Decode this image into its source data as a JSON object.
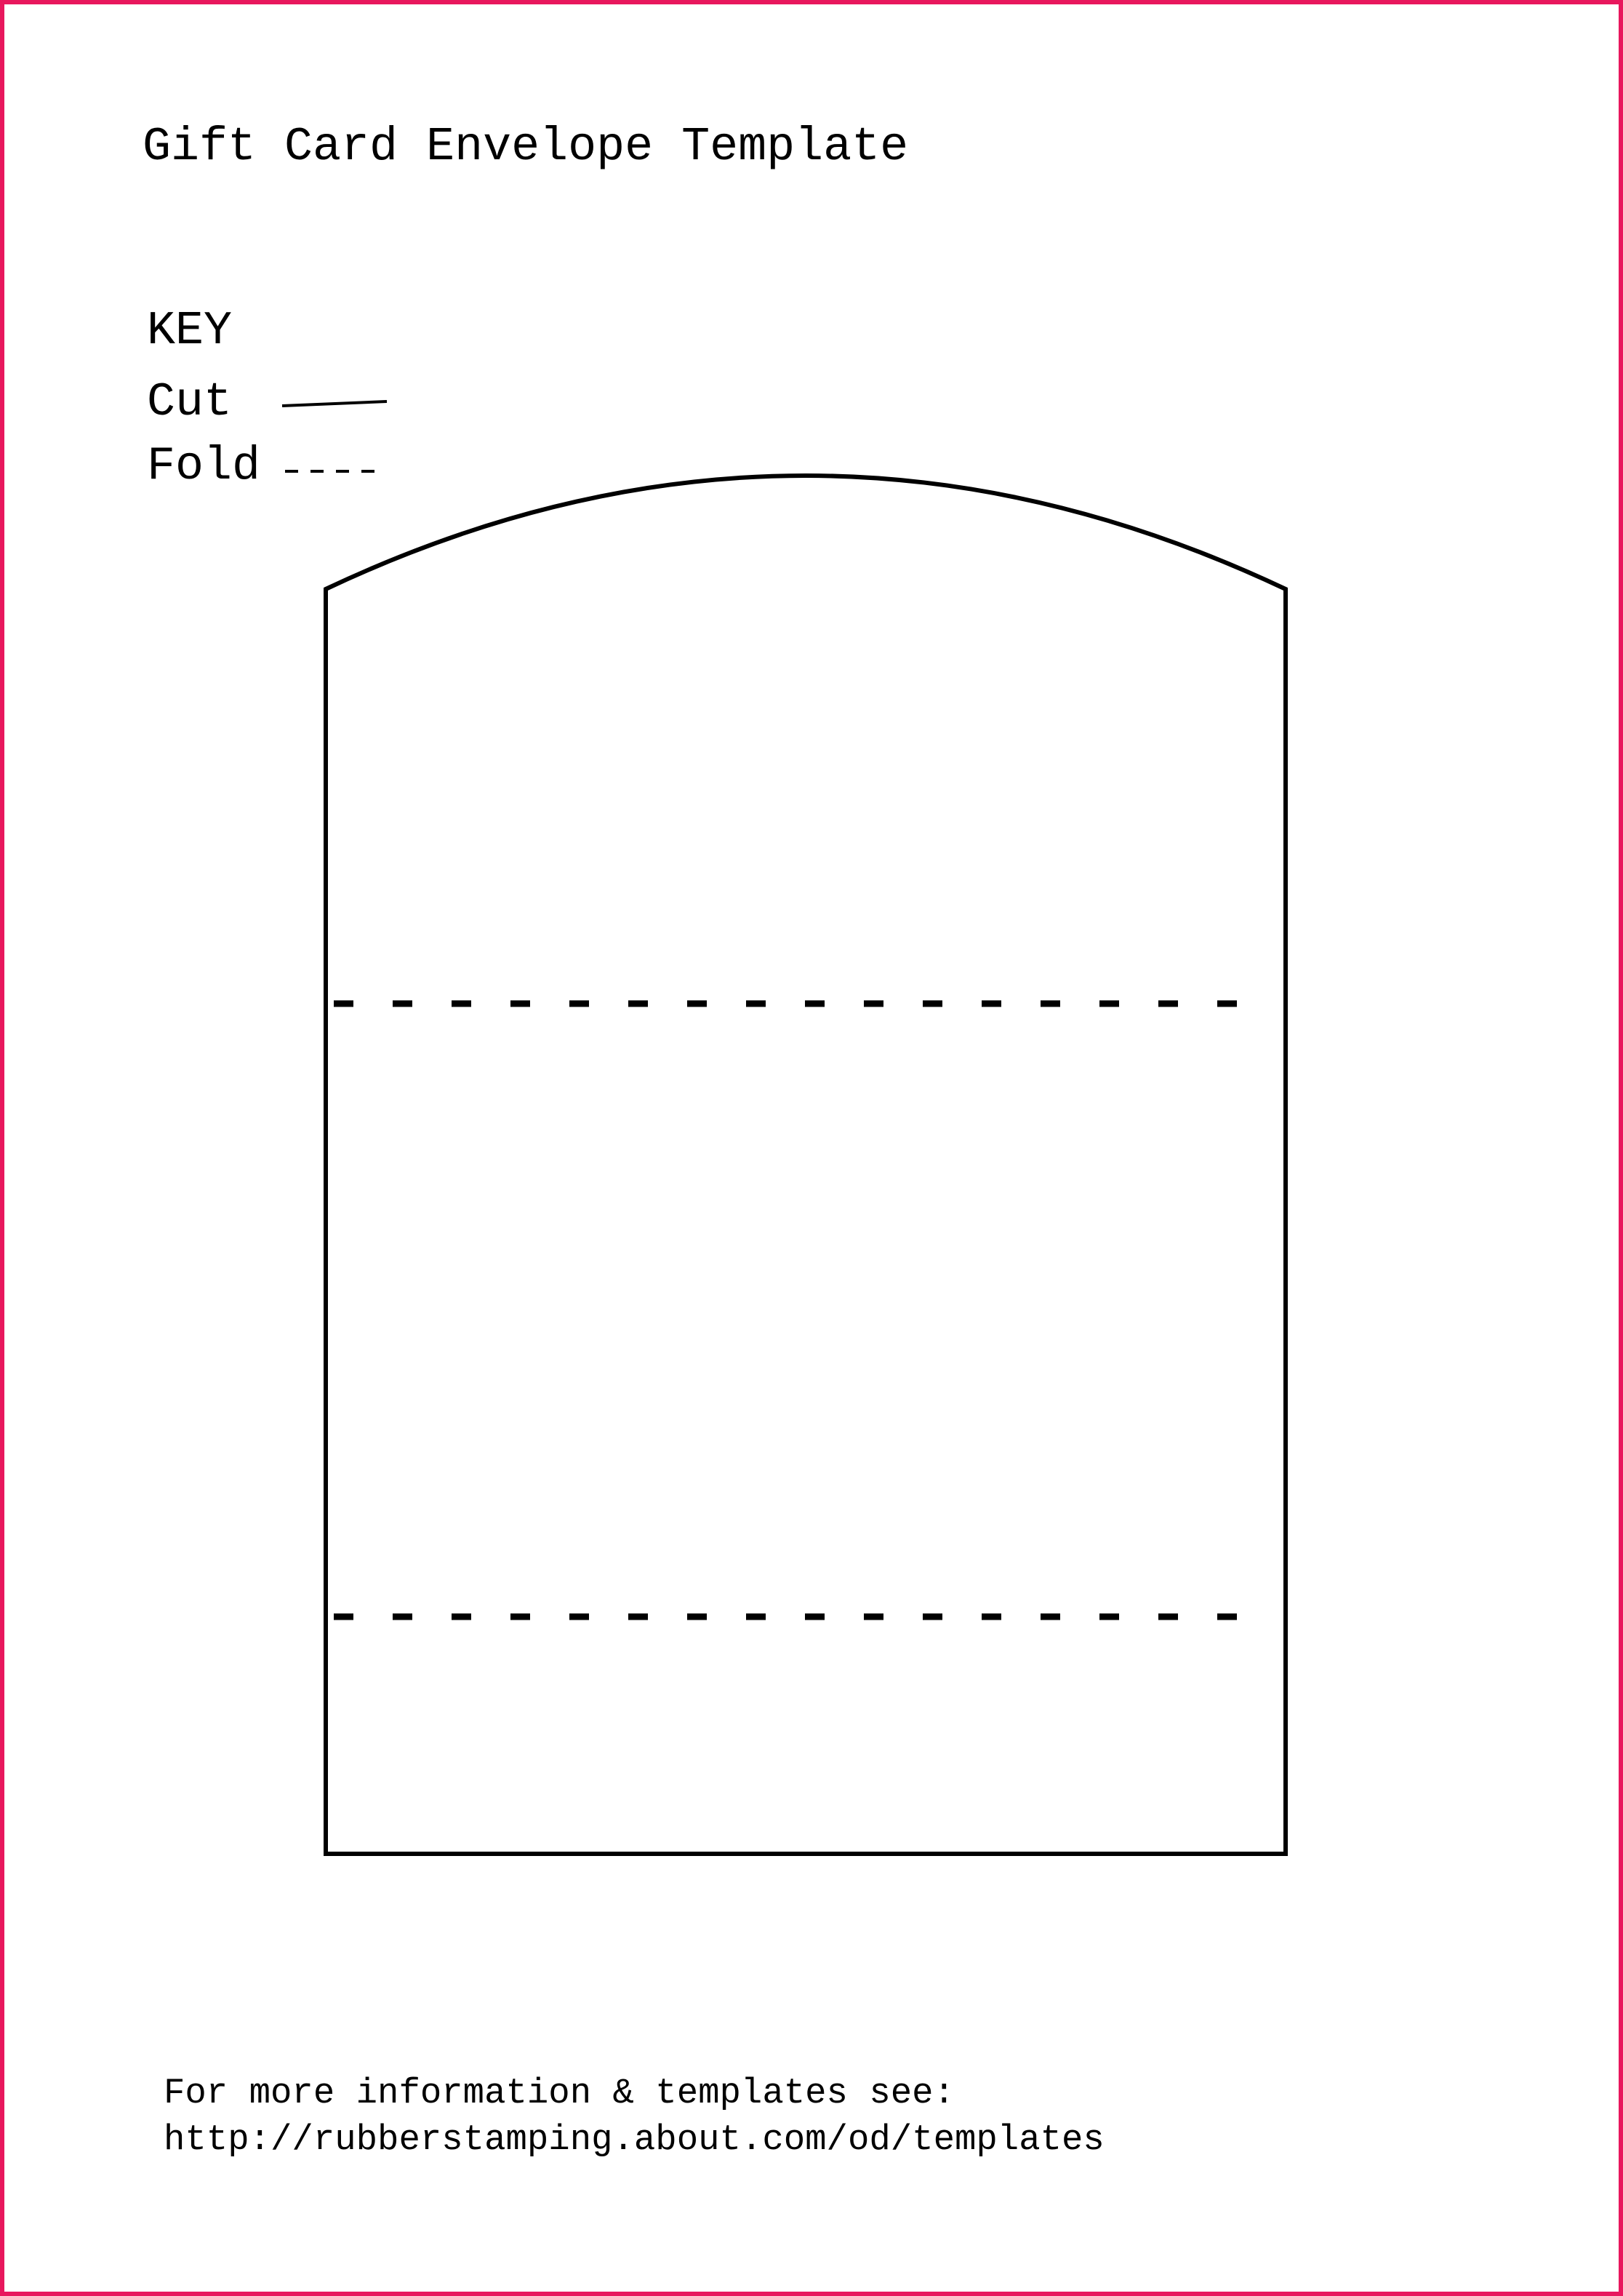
{
  "page": {
    "title": "Gift Card Envelope Template",
    "border_color": "#e8175d",
    "line_color": "#000000",
    "background_color": "#ffffff"
  },
  "key": {
    "heading": "KEY",
    "items": [
      {
        "label": "Cut",
        "line_style": "solid"
      },
      {
        "label": "Fold",
        "line_style": "dashed"
      }
    ]
  },
  "envelope": {
    "outline_style": "solid",
    "fold_lines_count": 2,
    "fold_line_style": "dashed"
  },
  "footer": {
    "line1": "For more information & templates see:",
    "line2": "http://rubberstamping.about.com/od/templates"
  }
}
